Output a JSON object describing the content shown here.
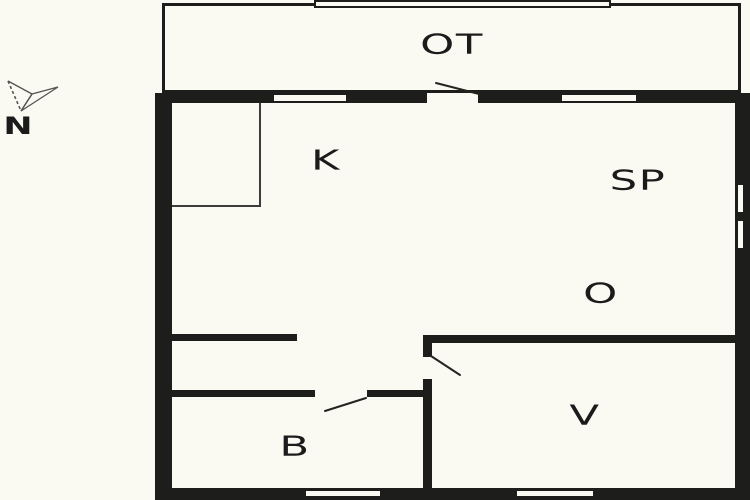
{
  "title": "Floor plan",
  "colors": {
    "wall": "#1d1d1b",
    "floor": "#fbfaf2",
    "thin_line": "#3c3c3a"
  },
  "compass": {
    "north_label": "N"
  },
  "rooms": {
    "ot": {
      "label": "OT"
    },
    "k": {
      "label": "K"
    },
    "sp": {
      "label": "SP"
    },
    "o": {
      "label": "O"
    },
    "b": {
      "label": "B"
    },
    "v": {
      "label": "V"
    }
  }
}
